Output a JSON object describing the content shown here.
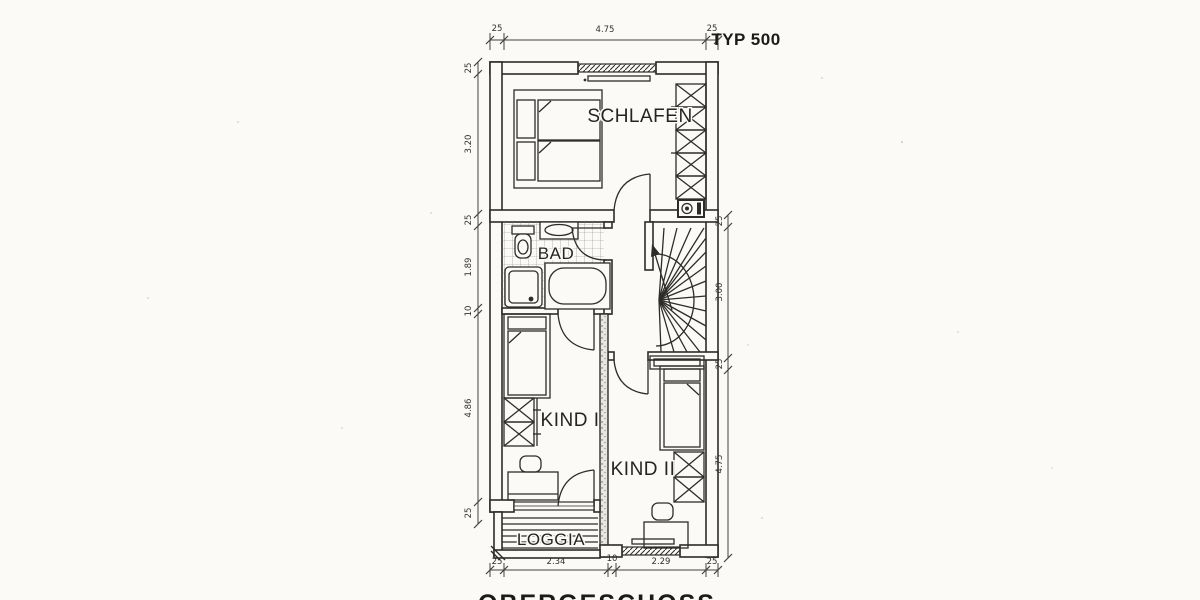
{
  "title": "TYP 500",
  "caption": "OBERGESCHOSS",
  "rooms": {
    "schlafen": "SCHLAFEN",
    "bad": "BAD",
    "kind1": "KIND I",
    "kind2": "KIND II",
    "loggia": "LOGGIA"
  },
  "dims": {
    "top": [
      "25",
      "4.75",
      "25"
    ],
    "left": [
      "25",
      "3.20",
      "25",
      "1.89",
      "10",
      "4.86",
      "25"
    ],
    "right": [
      "25",
      "3.00",
      "25",
      "4.75"
    ],
    "bottom": [
      "25",
      "2.34",
      "10",
      "2.29",
      "25"
    ]
  },
  "colors": {
    "ink": "#2e2c29",
    "paper": "#fbfaf7",
    "tile_grid": "#8a8a86"
  }
}
